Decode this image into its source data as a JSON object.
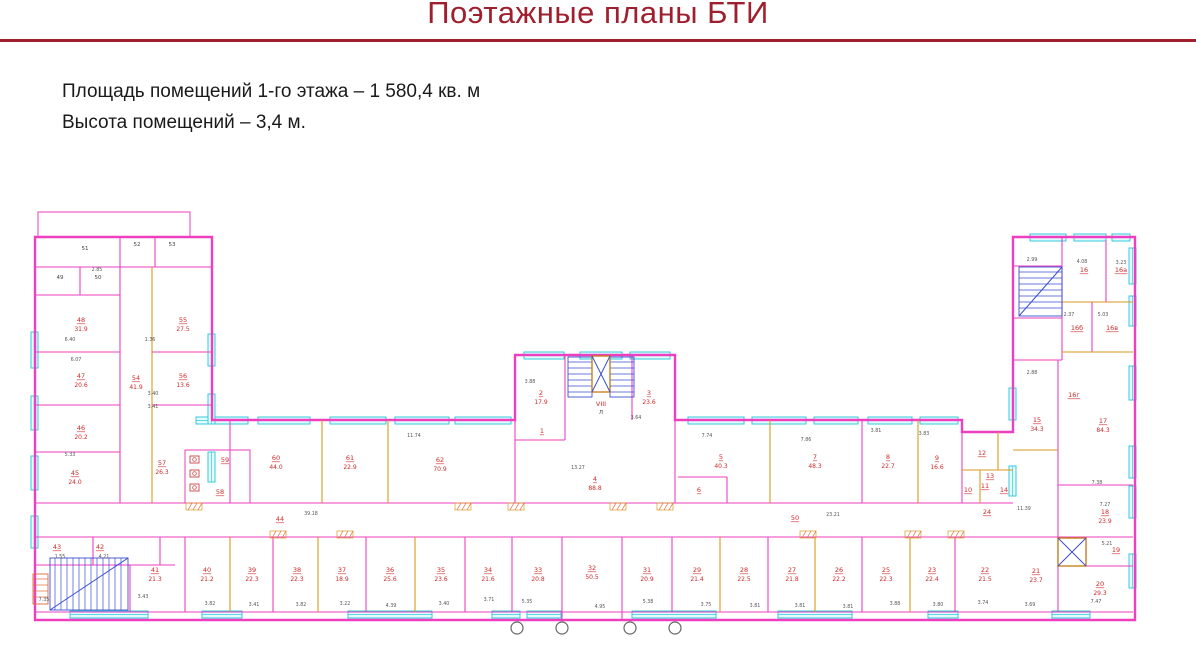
{
  "header": {
    "title": "Поэтажные планы БТИ"
  },
  "info": {
    "line1": "Площадь помещений 1-го этажа – 1 580,4 кв. м",
    "line2": "Высота помещений – 3,4 м."
  },
  "colors": {
    "title": "#9e1f2d",
    "wall": "#ee3fbe",
    "orange": "#d99a1e",
    "label": "#cc2a2a",
    "dim": "#555555",
    "window_stroke": "#35c8dd",
    "window_fill": "#e4fbfe",
    "stair": "#3a4fd0",
    "lift_frame": "#c07a10",
    "hatch": "#e06a3a",
    "circle": "#666666"
  },
  "plan": {
    "outline": "M35,237 H212 V420 H515 V355 H675 V420 H962 V432 H1013 V237 H1135 V620 H35 Z",
    "parapet": {
      "x": 38,
      "y": 212,
      "w": 152,
      "h": 25
    },
    "walls": [
      [
        35,
        267,
        212,
        267,
        "m"
      ],
      [
        120,
        237,
        120,
        267,
        "m"
      ],
      [
        155,
        237,
        155,
        267,
        "m"
      ],
      [
        80,
        267,
        80,
        295,
        "m"
      ],
      [
        35,
        295,
        120,
        295,
        "m"
      ],
      [
        120,
        267,
        120,
        503,
        "m"
      ],
      [
        152,
        267,
        152,
        503,
        "o"
      ],
      [
        35,
        352,
        120,
        352,
        "m"
      ],
      [
        152,
        352,
        212,
        352,
        "m"
      ],
      [
        35,
        405,
        120,
        405,
        "m"
      ],
      [
        152,
        405,
        212,
        405,
        "m"
      ],
      [
        35,
        452,
        120,
        452,
        "m"
      ],
      [
        35,
        503,
        1013,
        503,
        "m"
      ],
      [
        35,
        537,
        1013,
        537,
        "m"
      ],
      [
        93,
        537,
        93,
        565,
        "m"
      ],
      [
        160,
        537,
        160,
        565,
        "m"
      ],
      [
        35,
        565,
        175,
        565,
        "m"
      ],
      [
        130,
        565,
        130,
        612,
        "m"
      ],
      [
        185,
        537,
        185,
        612,
        "m"
      ],
      [
        230,
        420,
        230,
        503,
        "m"
      ],
      [
        322,
        420,
        322,
        503,
        "o"
      ],
      [
        388,
        420,
        388,
        503,
        "o"
      ],
      [
        515,
        420,
        515,
        503,
        "m"
      ],
      [
        675,
        420,
        675,
        503,
        "m"
      ],
      [
        565,
        355,
        565,
        440,
        "m"
      ],
      [
        632,
        355,
        632,
        420,
        "m"
      ],
      [
        515,
        440,
        565,
        440,
        "m"
      ],
      [
        770,
        420,
        770,
        503,
        "o"
      ],
      [
        862,
        420,
        862,
        503,
        "m"
      ],
      [
        918,
        420,
        918,
        503,
        "o"
      ],
      [
        678,
        477,
        727,
        477,
        "m"
      ],
      [
        727,
        477,
        727,
        503,
        "m"
      ],
      [
        962,
        432,
        962,
        503,
        "m"
      ],
      [
        962,
        470,
        1013,
        470,
        "o"
      ],
      [
        980,
        470,
        980,
        503,
        "o"
      ],
      [
        998,
        432,
        998,
        470,
        "o"
      ],
      [
        1013,
        266,
        1062,
        266,
        "m"
      ],
      [
        1062,
        237,
        1062,
        360,
        "m"
      ],
      [
        1013,
        318,
        1062,
        318,
        "m"
      ],
      [
        1062,
        302,
        1133,
        302,
        "o"
      ],
      [
        1106,
        240,
        1106,
        302,
        "m"
      ],
      [
        1092,
        302,
        1092,
        352,
        "m"
      ],
      [
        1062,
        352,
        1133,
        352,
        "o"
      ],
      [
        1013,
        360,
        1062,
        360,
        "m"
      ],
      [
        1058,
        360,
        1058,
        485,
        "m"
      ],
      [
        1013,
        450,
        1058,
        450,
        "o"
      ],
      [
        1058,
        485,
        1133,
        485,
        "m"
      ],
      [
        1058,
        537,
        1133,
        537,
        "m"
      ],
      [
        1058,
        485,
        1058,
        612,
        "m"
      ],
      [
        1013,
        537,
        1058,
        537,
        "m"
      ],
      [
        1086,
        537,
        1086,
        566,
        "m"
      ],
      [
        1058,
        566,
        1133,
        566,
        "m"
      ],
      [
        35,
        612,
        1133,
        612,
        "m"
      ],
      [
        230,
        537,
        230,
        612,
        "o"
      ],
      [
        273,
        537,
        273,
        612,
        "m"
      ],
      [
        318,
        537,
        318,
        612,
        "o"
      ],
      [
        366,
        537,
        366,
        612,
        "m"
      ],
      [
        415,
        537,
        415,
        612,
        "o"
      ],
      [
        465,
        537,
        465,
        612,
        "m"
      ],
      [
        512,
        537,
        512,
        612,
        "m"
      ],
      [
        562,
        537,
        562,
        620,
        "m"
      ],
      [
        622,
        537,
        622,
        620,
        "m"
      ],
      [
        672,
        537,
        672,
        612,
        "m"
      ],
      [
        720,
        537,
        720,
        612,
        "o"
      ],
      [
        768,
        537,
        768,
        612,
        "m"
      ],
      [
        815,
        537,
        815,
        612,
        "o"
      ],
      [
        862,
        537,
        862,
        612,
        "m"
      ],
      [
        910,
        537,
        910,
        612,
        "o"
      ],
      [
        955,
        537,
        955,
        612,
        "m"
      ]
    ],
    "toilets": {
      "x": 185,
      "y": 450,
      "w": 65,
      "h": 53,
      "fixtures": [
        [
          190,
          456
        ],
        [
          190,
          470
        ],
        [
          190,
          484
        ]
      ]
    },
    "stairs": [
      {
        "x": 50,
        "y": 558,
        "w": 78,
        "h": 52,
        "dir": "v",
        "diag": true,
        "c": "stair"
      },
      {
        "x": 568,
        "y": 357,
        "w": 24,
        "h": 40,
        "dir": "h",
        "diag": false,
        "c": "stair"
      },
      {
        "x": 610,
        "y": 357,
        "w": 24,
        "h": 40,
        "dir": "h",
        "diag": false,
        "c": "stair"
      },
      {
        "x": 1019,
        "y": 267,
        "w": 43,
        "h": 49,
        "dir": "h",
        "diag": true,
        "c": "stair"
      },
      {
        "x": 33,
        "y": 574,
        "w": 15,
        "h": 30,
        "dir": "h",
        "diag": false,
        "c": "hatch"
      }
    ],
    "lifts": [
      {
        "x": 592,
        "y": 356,
        "w": 18,
        "h": 36
      },
      {
        "x": 1058,
        "y": 538,
        "w": 28,
        "h": 28
      }
    ],
    "windows": [
      [
        196,
        417,
        52,
        7
      ],
      [
        258,
        417,
        52,
        7
      ],
      [
        330,
        417,
        56,
        7
      ],
      [
        395,
        417,
        54,
        7
      ],
      [
        455,
        417,
        56,
        7
      ],
      [
        688,
        417,
        56,
        7
      ],
      [
        752,
        417,
        54,
        7
      ],
      [
        814,
        417,
        44,
        7
      ],
      [
        868,
        417,
        44,
        7
      ],
      [
        920,
        417,
        38,
        7
      ],
      [
        524,
        352,
        40,
        7
      ],
      [
        580,
        352,
        42,
        7
      ],
      [
        630,
        352,
        40,
        7
      ],
      [
        1030,
        234,
        36,
        7
      ],
      [
        1074,
        234,
        32,
        7
      ],
      [
        1112,
        234,
        18,
        7
      ],
      [
        1129,
        248,
        7,
        36
      ],
      [
        1129,
        296,
        7,
        30
      ],
      [
        1129,
        366,
        7,
        34
      ],
      [
        1129,
        446,
        7,
        32
      ],
      [
        1129,
        486,
        7,
        32
      ],
      [
        1129,
        554,
        7,
        34
      ],
      [
        1009,
        388,
        7,
        32
      ],
      [
        1009,
        466,
        7,
        30
      ],
      [
        31,
        332,
        7,
        36
      ],
      [
        31,
        396,
        7,
        34
      ],
      [
        31,
        456,
        7,
        34
      ],
      [
        31,
        516,
        7,
        32
      ],
      [
        208,
        334,
        7,
        32
      ],
      [
        208,
        394,
        7,
        30
      ],
      [
        208,
        452,
        7,
        30
      ],
      [
        70,
        611,
        78,
        7
      ],
      [
        202,
        611,
        40,
        7
      ],
      [
        348,
        611,
        84,
        7
      ],
      [
        492,
        611,
        28,
        7
      ],
      [
        527,
        611,
        34,
        7
      ],
      [
        632,
        611,
        84,
        7
      ],
      [
        778,
        611,
        74,
        7
      ],
      [
        928,
        611,
        30,
        7
      ],
      [
        1052,
        611,
        38,
        7
      ]
    ],
    "hatches": [
      [
        186,
        503
      ],
      [
        270,
        531
      ],
      [
        337,
        531
      ],
      [
        455,
        503
      ],
      [
        508,
        503
      ],
      [
        610,
        503
      ],
      [
        657,
        503
      ],
      [
        800,
        531
      ],
      [
        905,
        531
      ],
      [
        948,
        531
      ]
    ],
    "circles": [
      [
        517,
        628
      ],
      [
        562,
        628
      ],
      [
        630,
        628
      ],
      [
        675,
        628
      ]
    ],
    "rooms": [
      {
        "n": "48",
        "a": "31.9",
        "x": 81,
        "y": 322
      },
      {
        "n": "55",
        "a": "27.5",
        "x": 183,
        "y": 322
      },
      {
        "n": "47",
        "a": "20.6",
        "x": 81,
        "y": 378
      },
      {
        "n": "54",
        "a": "41.9",
        "x": 136,
        "y": 380
      },
      {
        "n": "56",
        "a": "13.6",
        "x": 183,
        "y": 378
      },
      {
        "n": "46",
        "a": "20.2",
        "x": 81,
        "y": 430
      },
      {
        "n": "45",
        "a": "24.0",
        "x": 75,
        "y": 475
      },
      {
        "n": "57",
        "a": "26.3",
        "x": 162,
        "y": 465
      },
      {
        "n": "59",
        "a": "",
        "x": 225,
        "y": 462
      },
      {
        "n": "58",
        "a": "",
        "x": 220,
        "y": 494
      },
      {
        "n": "43",
        "a": "",
        "x": 57,
        "y": 549
      },
      {
        "n": "42",
        "a": "",
        "x": 100,
        "y": 549
      },
      {
        "n": "41",
        "a": "21.3",
        "x": 155,
        "y": 572
      },
      {
        "n": "44",
        "a": "",
        "x": 280,
        "y": 521
      },
      {
        "n": "50",
        "a": "",
        "x": 795,
        "y": 520
      },
      {
        "n": "24",
        "a": "",
        "x": 987,
        "y": 514
      },
      {
        "n": "60",
        "a": "44.0",
        "x": 276,
        "y": 460
      },
      {
        "n": "61",
        "a": "22.9",
        "x": 350,
        "y": 460
      },
      {
        "n": "62",
        "a": "70.9",
        "x": 440,
        "y": 462
      },
      {
        "n": "1",
        "a": "",
        "x": 542,
        "y": 433
      },
      {
        "n": "2",
        "a": "17.9",
        "x": 541,
        "y": 395
      },
      {
        "n": "VIII",
        "a": "",
        "x": 601,
        "y": 406
      },
      {
        "n": "3",
        "a": "23.6",
        "x": 649,
        "y": 395
      },
      {
        "n": "4",
        "a": "88.8",
        "x": 595,
        "y": 481
      },
      {
        "n": "5",
        "a": "40.3",
        "x": 721,
        "y": 459
      },
      {
        "n": "6",
        "a": "",
        "x": 699,
        "y": 492
      },
      {
        "n": "7",
        "a": "48.3",
        "x": 815,
        "y": 459
      },
      {
        "n": "8",
        "a": "22.7",
        "x": 888,
        "y": 459
      },
      {
        "n": "9",
        "a": "16.6",
        "x": 937,
        "y": 460
      },
      {
        "n": "12",
        "a": "",
        "x": 982,
        "y": 455
      },
      {
        "n": "13",
        "a": "",
        "x": 990,
        "y": 478
      },
      {
        "n": "14",
        "a": "",
        "x": 1004,
        "y": 492
      },
      {
        "n": "10",
        "a": "",
        "x": 968,
        "y": 492
      },
      {
        "n": "11",
        "a": "",
        "x": 985,
        "y": 488
      },
      {
        "n": "15",
        "a": "34.3",
        "x": 1037,
        "y": 422
      },
      {
        "n": "16",
        "a": "",
        "x": 1084,
        "y": 272
      },
      {
        "n": "16а",
        "a": "",
        "x": 1121,
        "y": 272
      },
      {
        "n": "16б",
        "a": "",
        "x": 1077,
        "y": 330
      },
      {
        "n": "16в",
        "a": "",
        "x": 1112,
        "y": 330
      },
      {
        "n": "16г",
        "a": "",
        "x": 1074,
        "y": 397
      },
      {
        "n": "17",
        "a": "84.3",
        "x": 1103,
        "y": 423
      },
      {
        "n": "18",
        "a": "23.9",
        "x": 1105,
        "y": 514
      },
      {
        "n": "19",
        "a": "",
        "x": 1116,
        "y": 552
      },
      {
        "n": "20",
        "a": "29.3",
        "x": 1100,
        "y": 586
      },
      {
        "n": "21",
        "a": "23.7",
        "x": 1036,
        "y": 573
      },
      {
        "n": "40",
        "a": "21.2",
        "x": 207,
        "y": 572
      },
      {
        "n": "39",
        "a": "22.3",
        "x": 252,
        "y": 572
      },
      {
        "n": "38",
        "a": "22.3",
        "x": 297,
        "y": 572
      },
      {
        "n": "37",
        "a": "18.9",
        "x": 342,
        "y": 572
      },
      {
        "n": "36",
        "a": "25.6",
        "x": 390,
        "y": 572
      },
      {
        "n": "35",
        "a": "23.6",
        "x": 441,
        "y": 572
      },
      {
        "n": "34",
        "a": "21.6",
        "x": 488,
        "y": 572
      },
      {
        "n": "33",
        "a": "20.8",
        "x": 538,
        "y": 572
      },
      {
        "n": "32",
        "a": "50.5",
        "x": 592,
        "y": 570
      },
      {
        "n": "31",
        "a": "20.9",
        "x": 647,
        "y": 572
      },
      {
        "n": "29",
        "a": "21.4",
        "x": 697,
        "y": 572
      },
      {
        "n": "28",
        "a": "22.5",
        "x": 744,
        "y": 572
      },
      {
        "n": "27",
        "a": "21.8",
        "x": 792,
        "y": 572
      },
      {
        "n": "26",
        "a": "22.2",
        "x": 839,
        "y": 572
      },
      {
        "n": "25",
        "a": "22.3",
        "x": 886,
        "y": 572
      },
      {
        "n": "23",
        "a": "22.4",
        "x": 932,
        "y": 572
      },
      {
        "n": "22",
        "a": "21.5",
        "x": 985,
        "y": 572
      }
    ],
    "black_labels": [
      [
        "51",
        85,
        250
      ],
      [
        "52",
        137,
        246
      ],
      [
        "53",
        172,
        246
      ],
      [
        "49",
        60,
        279
      ],
      [
        "50",
        98,
        279
      ],
      [
        "Л",
        601,
        414
      ]
    ],
    "dims": [
      [
        "2.85",
        97,
        271
      ],
      [
        "6.40",
        70,
        341
      ],
      [
        "6.07",
        76,
        361
      ],
      [
        "1.36",
        150,
        341
      ],
      [
        "3.40",
        153,
        395
      ],
      [
        "3.41",
        153,
        408
      ],
      [
        "5.33",
        70,
        456
      ],
      [
        "1.55",
        60,
        558
      ],
      [
        "4.21",
        104,
        558
      ],
      [
        "7.35",
        44,
        601
      ],
      [
        "3.43",
        143,
        598
      ],
      [
        "39.18",
        311,
        515
      ],
      [
        "11.74",
        414,
        437
      ],
      [
        "3.88",
        530,
        383
      ],
      [
        "3.64",
        636,
        419
      ],
      [
        "13.27",
        578,
        469
      ],
      [
        "7.74",
        707,
        437
      ],
      [
        "7.86",
        806,
        441
      ],
      [
        "3.81",
        876,
        432
      ],
      [
        "3.83",
        924,
        435
      ],
      [
        "23.21",
        833,
        516
      ],
      [
        "11.39",
        1024,
        510
      ],
      [
        "2.99",
        1032,
        261
      ],
      [
        "4.08",
        1082,
        263
      ],
      [
        "3.23",
        1121,
        264
      ],
      [
        "2.37",
        1069,
        316
      ],
      [
        "5.03",
        1103,
        316
      ],
      [
        "2.88",
        1032,
        374
      ],
      [
        "7.38",
        1097,
        484
      ],
      [
        "7.27",
        1105,
        506
      ],
      [
        "5.21",
        1107,
        545
      ],
      [
        "7.47",
        1096,
        603
      ],
      [
        "3.82",
        210,
        605
      ],
      [
        "3.41",
        254,
        606
      ],
      [
        "3.82",
        301,
        606
      ],
      [
        "3.22",
        345,
        605
      ],
      [
        "4.39",
        391,
        607
      ],
      [
        "3.40",
        444,
        605
      ],
      [
        "3.71",
        489,
        601
      ],
      [
        "5.35",
        527,
        603
      ],
      [
        "4.95",
        600,
        608
      ],
      [
        "5.38",
        648,
        603
      ],
      [
        "3.75",
        706,
        606
      ],
      [
        "3.81",
        755,
        607
      ],
      [
        "3.81",
        800,
        607
      ],
      [
        "3.81",
        848,
        608
      ],
      [
        "3.88",
        895,
        605
      ],
      [
        "3.80",
        938,
        606
      ],
      [
        "3.74",
        983,
        604
      ],
      [
        "3.69",
        1030,
        606
      ]
    ]
  }
}
